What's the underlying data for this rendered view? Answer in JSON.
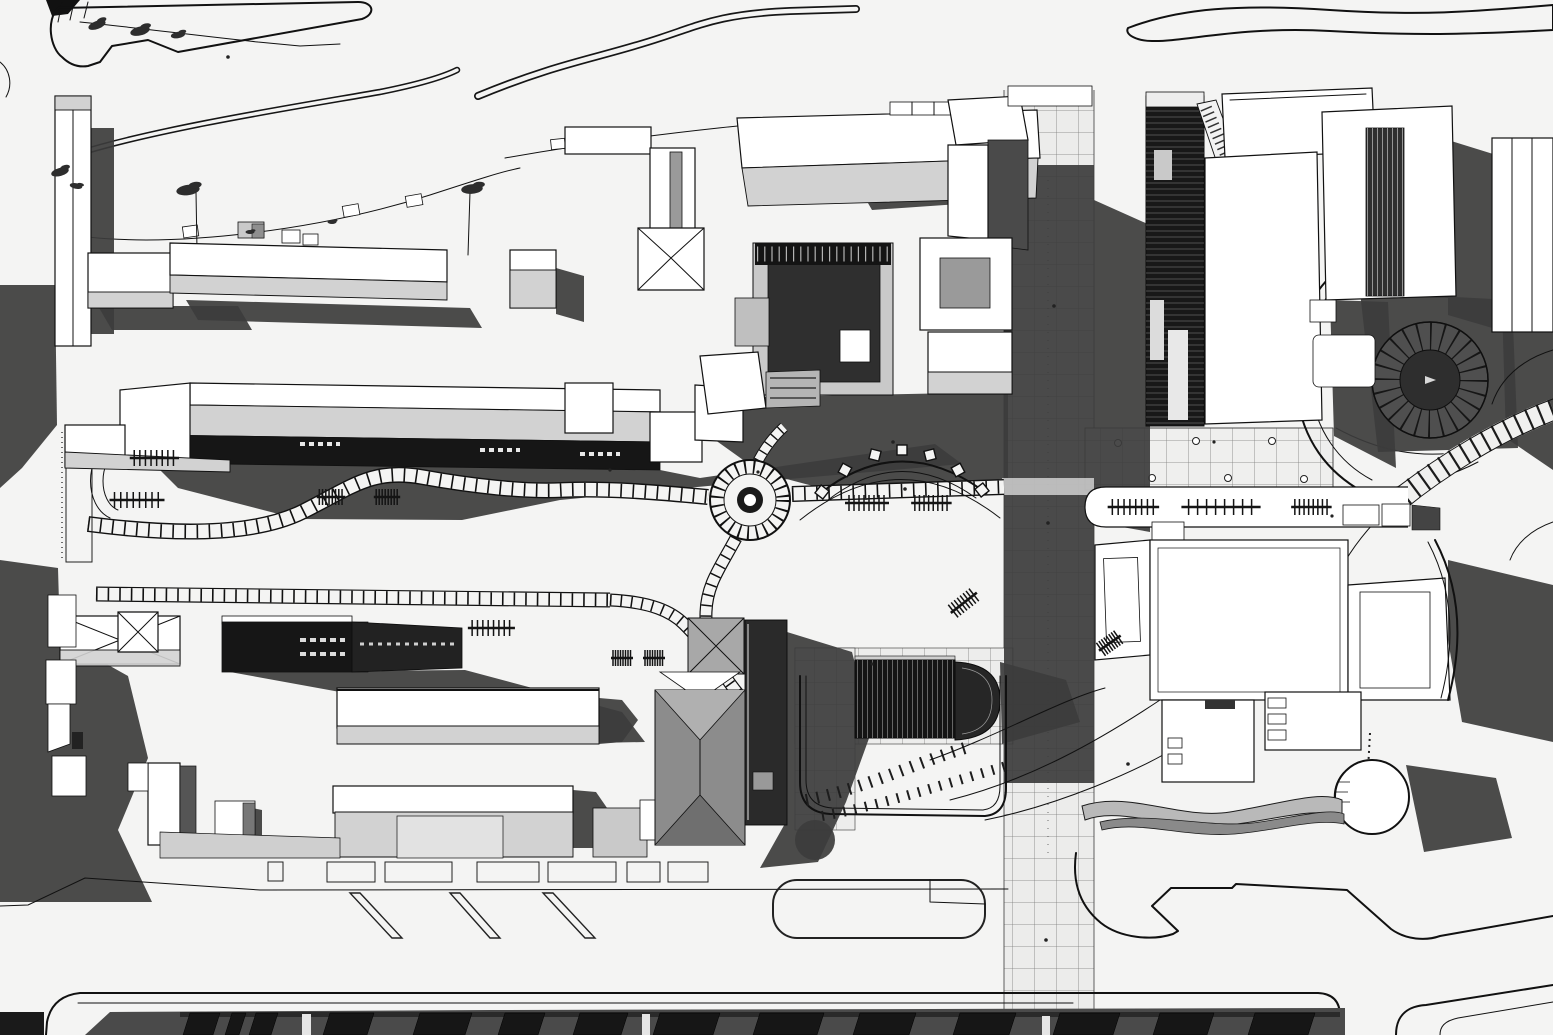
{
  "canvas": {
    "width": 1553,
    "height": 1035,
    "aria_label": "Monochrome architectural site plan, axonometric top-down view of a campus block with buildings, plazas, paths and cast shadows"
  },
  "palette": {
    "bg": "#f4f4f3",
    "line": "#111111",
    "white": "#ffffff",
    "roofL": "#d2d2d2",
    "roofM": "#9a9a9a",
    "facade": "#161616",
    "shadow": "#3c3c3c",
    "shadow2": "#4a4a4a",
    "tile": "#4a4a4a",
    "tree": "#2d2d2d"
  },
  "scene": {
    "type": "architectural-site-plan",
    "style": "black-and-white axonometric aerial rendering with hard cast shadows",
    "features": [
      {
        "name": "loop-road-top-left",
        "desc": "closed loop access road with tree scribbles"
      },
      {
        "name": "ribbon-road-top",
        "desc": "S-shaped narrow road band"
      },
      {
        "name": "leaf-median-top-right",
        "desc": "leaf-shaped road median outline"
      },
      {
        "name": "row-buildings-upper-left",
        "desc": "two long low buildings with light roof slopes and drop shadows"
      },
      {
        "name": "courtyard-complex",
        "desc": "U-shaped building group around a dark inner courtyard"
      },
      {
        "name": "promenade-walkway",
        "desc": "vertical tiled pedestrian promenade, mostly in shadow"
      },
      {
        "name": "facade-tower",
        "desc": "tall dark detailed building facade"
      },
      {
        "name": "right-towers",
        "desc": "pair of large white roofed towers"
      },
      {
        "name": "spiral-stair",
        "desc": "circular radial stair / amphitheater in shadow"
      },
      {
        "name": "tie-arc-path",
        "desc": "curved stepped path with cross ties"
      },
      {
        "name": "central-roundabout",
        "desc": "circular plaza node with radial paving ring"
      },
      {
        "name": "serpentine-path",
        "desc": "meandering paved path with cross pavers"
      },
      {
        "name": "pergola-arc",
        "desc": "arched trellis with square posts"
      },
      {
        "name": "benches",
        "desc": "railroad-tie styled benches along paths"
      },
      {
        "name": "lower-left-complex",
        "desc": "village of hip-roof buildings with dark street facade"
      },
      {
        "name": "barrel-greenhouse",
        "desc": "dark ribbed barrel-vault roof with rounded apse"
      },
      {
        "name": "lower-right-complex",
        "desc": "large white courtyard building with cylinder pavilion and ribbon canopy"
      },
      {
        "name": "parking-row",
        "desc": "parking bays with diagonal dividers"
      },
      {
        "name": "bottom-street-strip",
        "desc": "dark row of rooftops along the bottom edge"
      }
    ]
  }
}
